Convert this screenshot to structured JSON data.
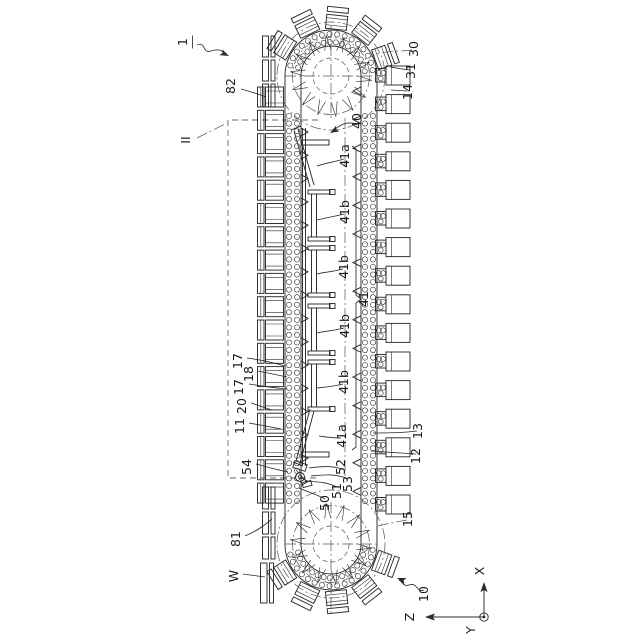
{
  "figure": {
    "colors": {
      "line": "#2b2b2b",
      "background": "#ffffff",
      "dash": "#555555"
    },
    "labels": {
      "l1": "1",
      "l82": "82",
      "lII": "II",
      "l30": "30",
      "l31": "31",
      "l14": "14",
      "l40": "40",
      "l41a_top": "41a",
      "l41b_1": "41b",
      "l41b_2": "41b",
      "l41": "41",
      "l41b_3": "41b",
      "l41b_4": "41b",
      "l41a_bot": "41a",
      "l17_top": "17",
      "l18": "18",
      "l17_bot": "17",
      "l20": "20",
      "l11": "11",
      "l54": "54",
      "l52": "52",
      "l53": "53",
      "l51": "51",
      "l50": "50",
      "l13": "13",
      "l12": "12",
      "l15": "15",
      "l81": "81",
      "lW": "W",
      "l10": "10",
      "axis_x": "X",
      "axis_y": "Y",
      "axis_z": "Z"
    }
  }
}
